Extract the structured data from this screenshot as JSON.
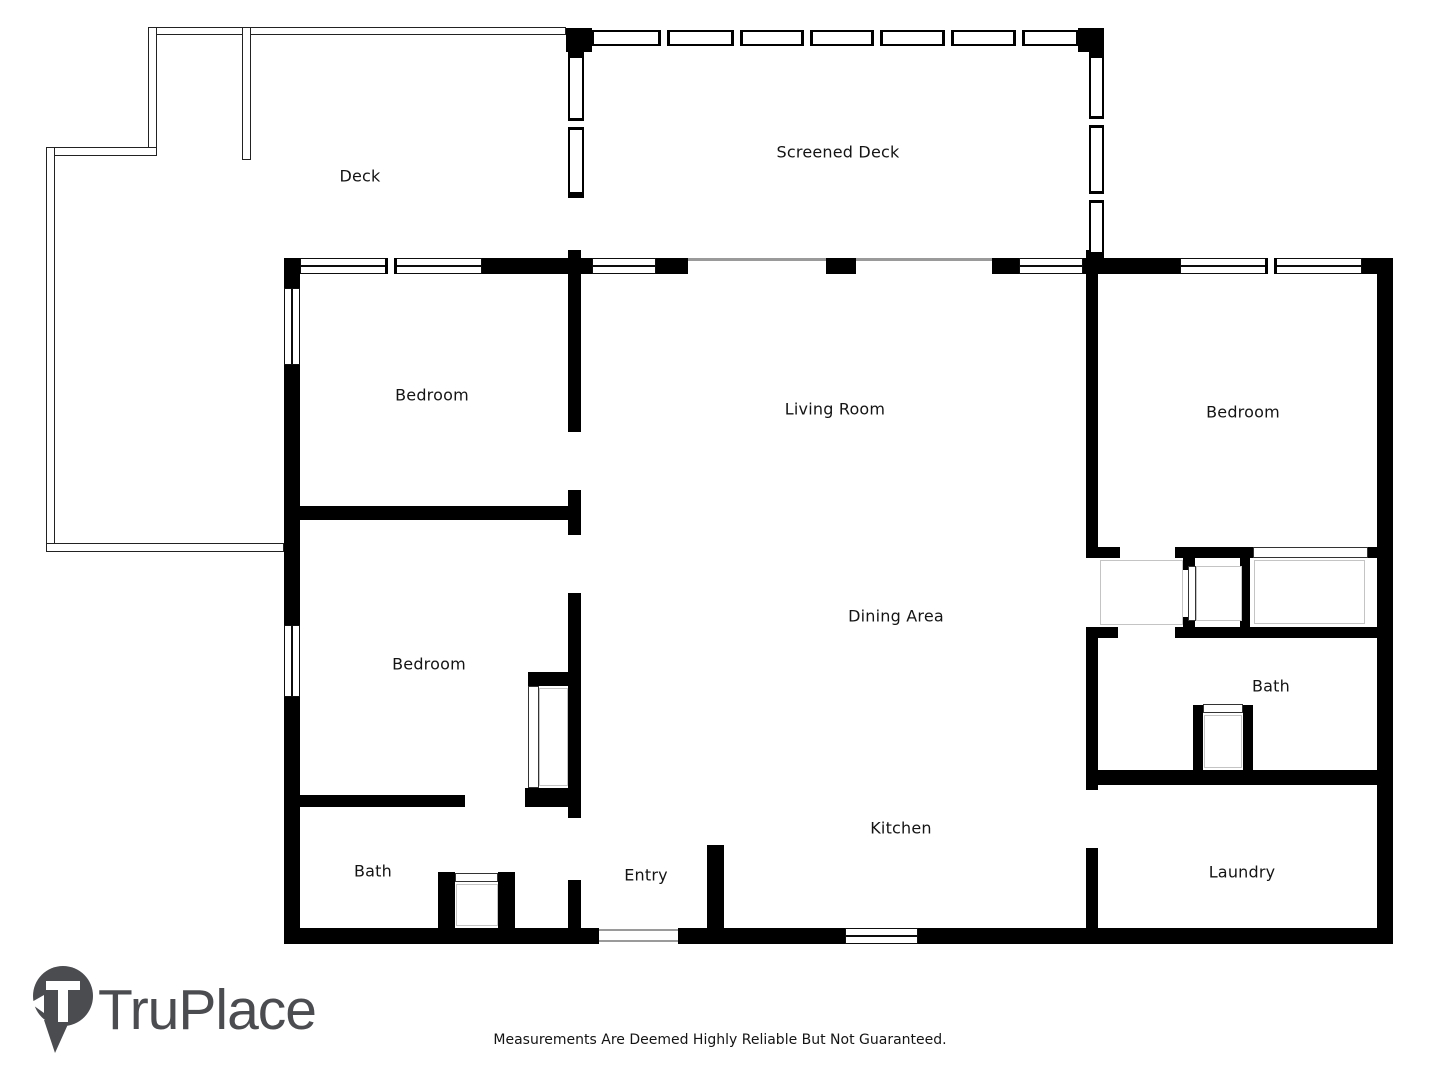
{
  "rooms": [
    {
      "id": "deck",
      "label": "Deck"
    },
    {
      "id": "screened-deck",
      "label": "Screened Deck"
    },
    {
      "id": "bedroom-top-left",
      "label": "Bedroom"
    },
    {
      "id": "living-room",
      "label": "Living Room"
    },
    {
      "id": "bedroom-right",
      "label": "Bedroom"
    },
    {
      "id": "bedroom-bottom-left",
      "label": "Bedroom"
    },
    {
      "id": "dining-area",
      "label": "Dining Area"
    },
    {
      "id": "bath-right",
      "label": "Bath"
    },
    {
      "id": "bath-left",
      "label": "Bath"
    },
    {
      "id": "entry",
      "label": "Entry"
    },
    {
      "id": "kitchen",
      "label": "Kitchen"
    },
    {
      "id": "laundry",
      "label": "Laundry"
    }
  ],
  "branding": {
    "logo_text": "TruPlace",
    "logo_color": "#4b4c50",
    "logo_icon": "map-pin-icon"
  },
  "footer": {
    "disclaimer": "Measurements Are Deemed Highly Reliable But Not Guaranteed."
  },
  "colors": {
    "wall": "#000000",
    "background": "#ffffff",
    "thin_line": "#222222",
    "light_line": "#c4c4c4",
    "label_text": "#141414"
  }
}
